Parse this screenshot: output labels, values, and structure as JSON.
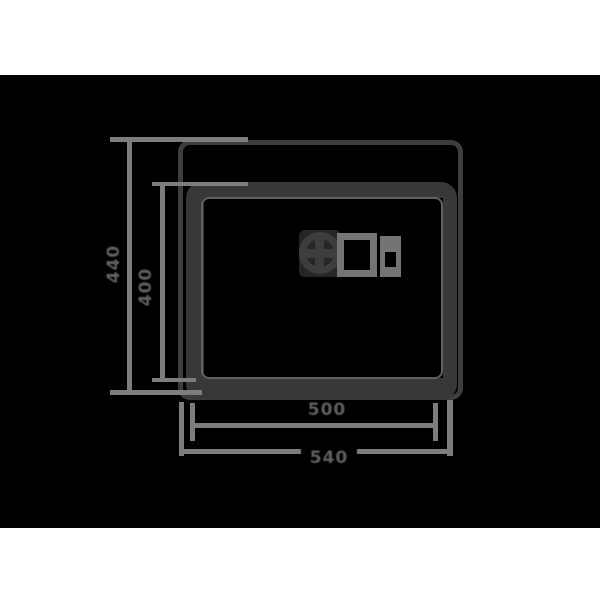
{
  "diagram": {
    "name": "sink-dimension-drawing",
    "view": "top view with drain and overflow fitting",
    "dimensions": {
      "bottom_inner": "500",
      "bottom_outer": "540",
      "left_outer": "440",
      "left_inner": "400"
    },
    "colors": {
      "background": "#000000",
      "margin_band": "#ffffff",
      "outline": "#3d3d3d",
      "outline_heavy": "#383838",
      "secondary_line": "#606060",
      "dimension_line": "#7d7d7d",
      "label_text": "#5e5e5e",
      "fitting": "#747474",
      "drain_backplate": "#262626"
    }
  }
}
